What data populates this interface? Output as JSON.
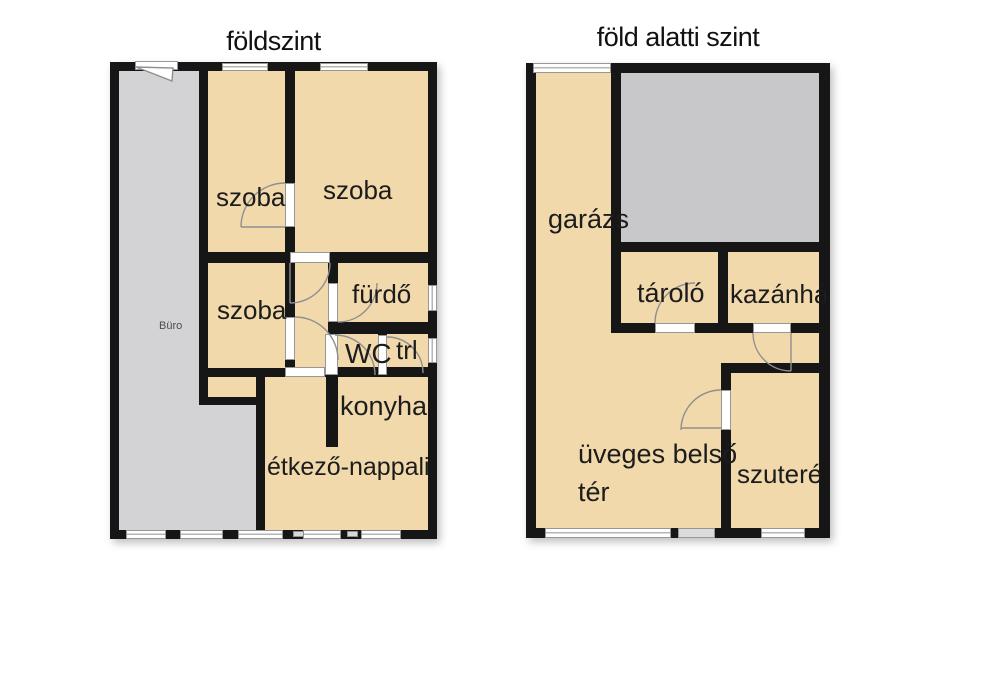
{
  "page": {
    "background_color": "#ffffff"
  },
  "colors": {
    "wall": "#161616",
    "room_fill": "#f1d9ac",
    "office_gray": "#d3d3d5",
    "terrain_gray": "#c8c8ca",
    "door_swing": "#8f8f8f"
  },
  "plans": {
    "ground_floor": {
      "title": "földszint",
      "rooms": {
        "buro": "Büro",
        "szoba1": "szoba",
        "szoba2": "szoba",
        "szoba3": "szoba",
        "furdo": "fürdő",
        "wc": "WC",
        "trl": "trl",
        "konyha": "konyha",
        "etkezo": "étkező-nappali"
      }
    },
    "basement": {
      "title": "föld alatti szint",
      "rooms": {
        "garazs": "garázs",
        "tarolo": "tároló",
        "kazanhaz": "kazánház",
        "uveges_line1": "üveges belső",
        "uveges_line2": "tér",
        "szuteren": "szuterén"
      }
    }
  }
}
